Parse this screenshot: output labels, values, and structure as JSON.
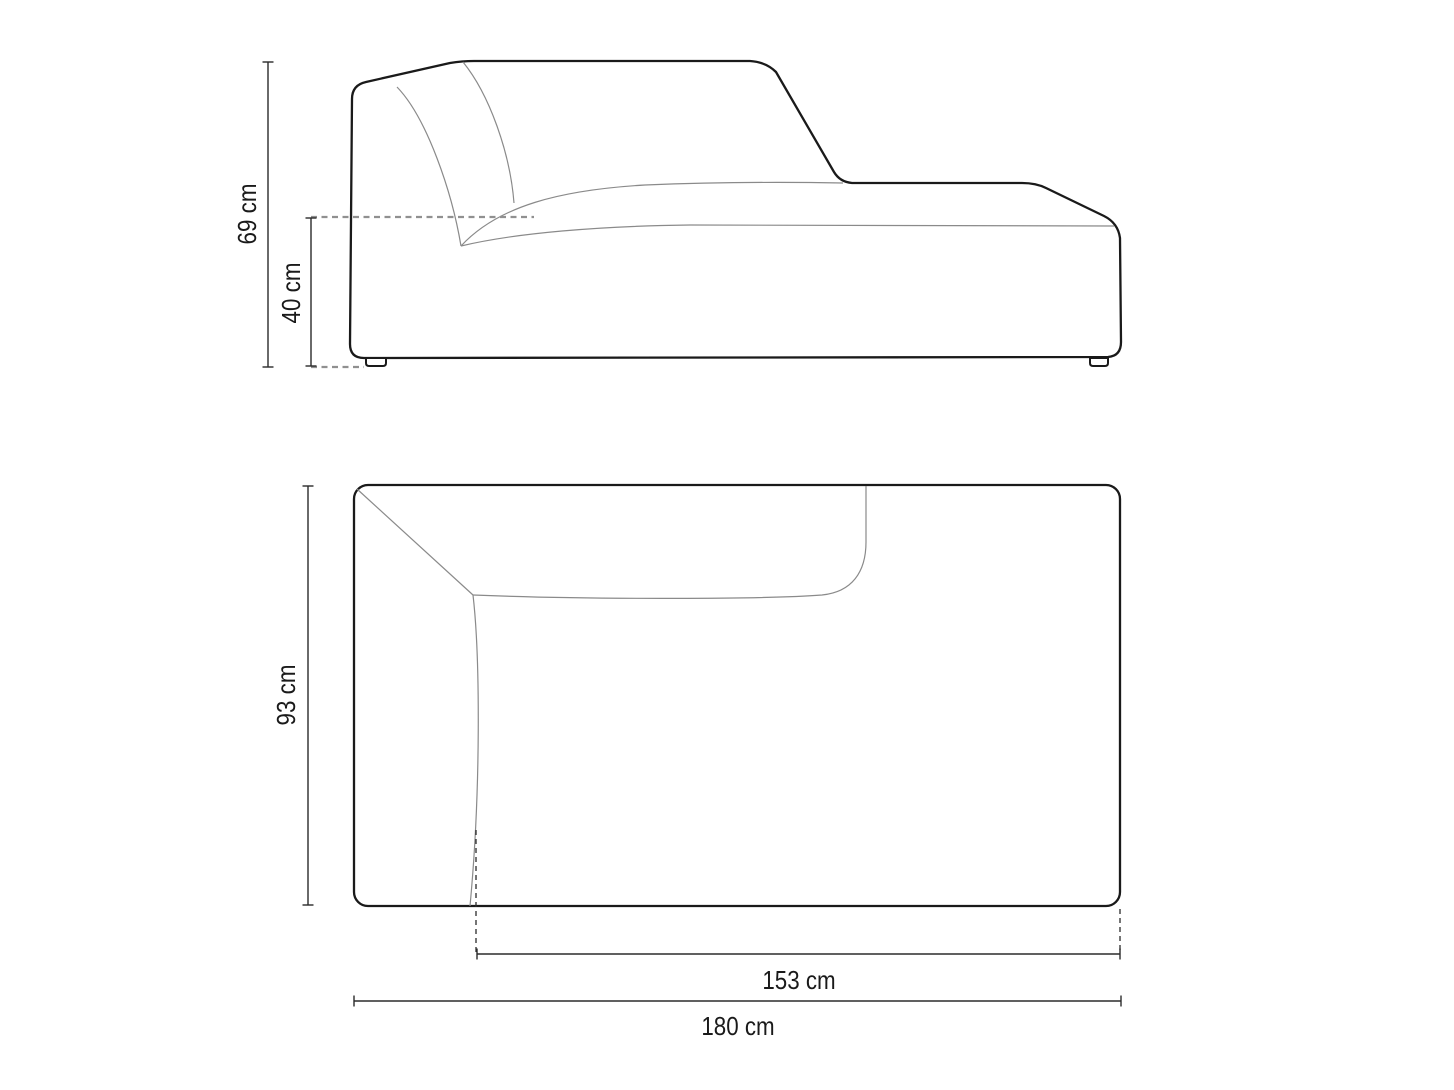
{
  "diagram": {
    "title": "sofa-module-dimension-drawing",
    "views": {
      "side_view": {
        "total_height_label": "69 cm",
        "seat_height_label": "40 cm"
      },
      "top_view": {
        "depth_label": "93 cm",
        "seat_width_label": "153 cm",
        "total_width_label": "180 cm"
      }
    },
    "colors": {
      "background": "#ffffff",
      "outline": "#1a1a1a",
      "seam_line": "#8a8a8a",
      "dimension_line": "#2b2b2b",
      "guide_dash_gray": "#909090",
      "extension_dash_dark": "#2b2b2b"
    }
  }
}
